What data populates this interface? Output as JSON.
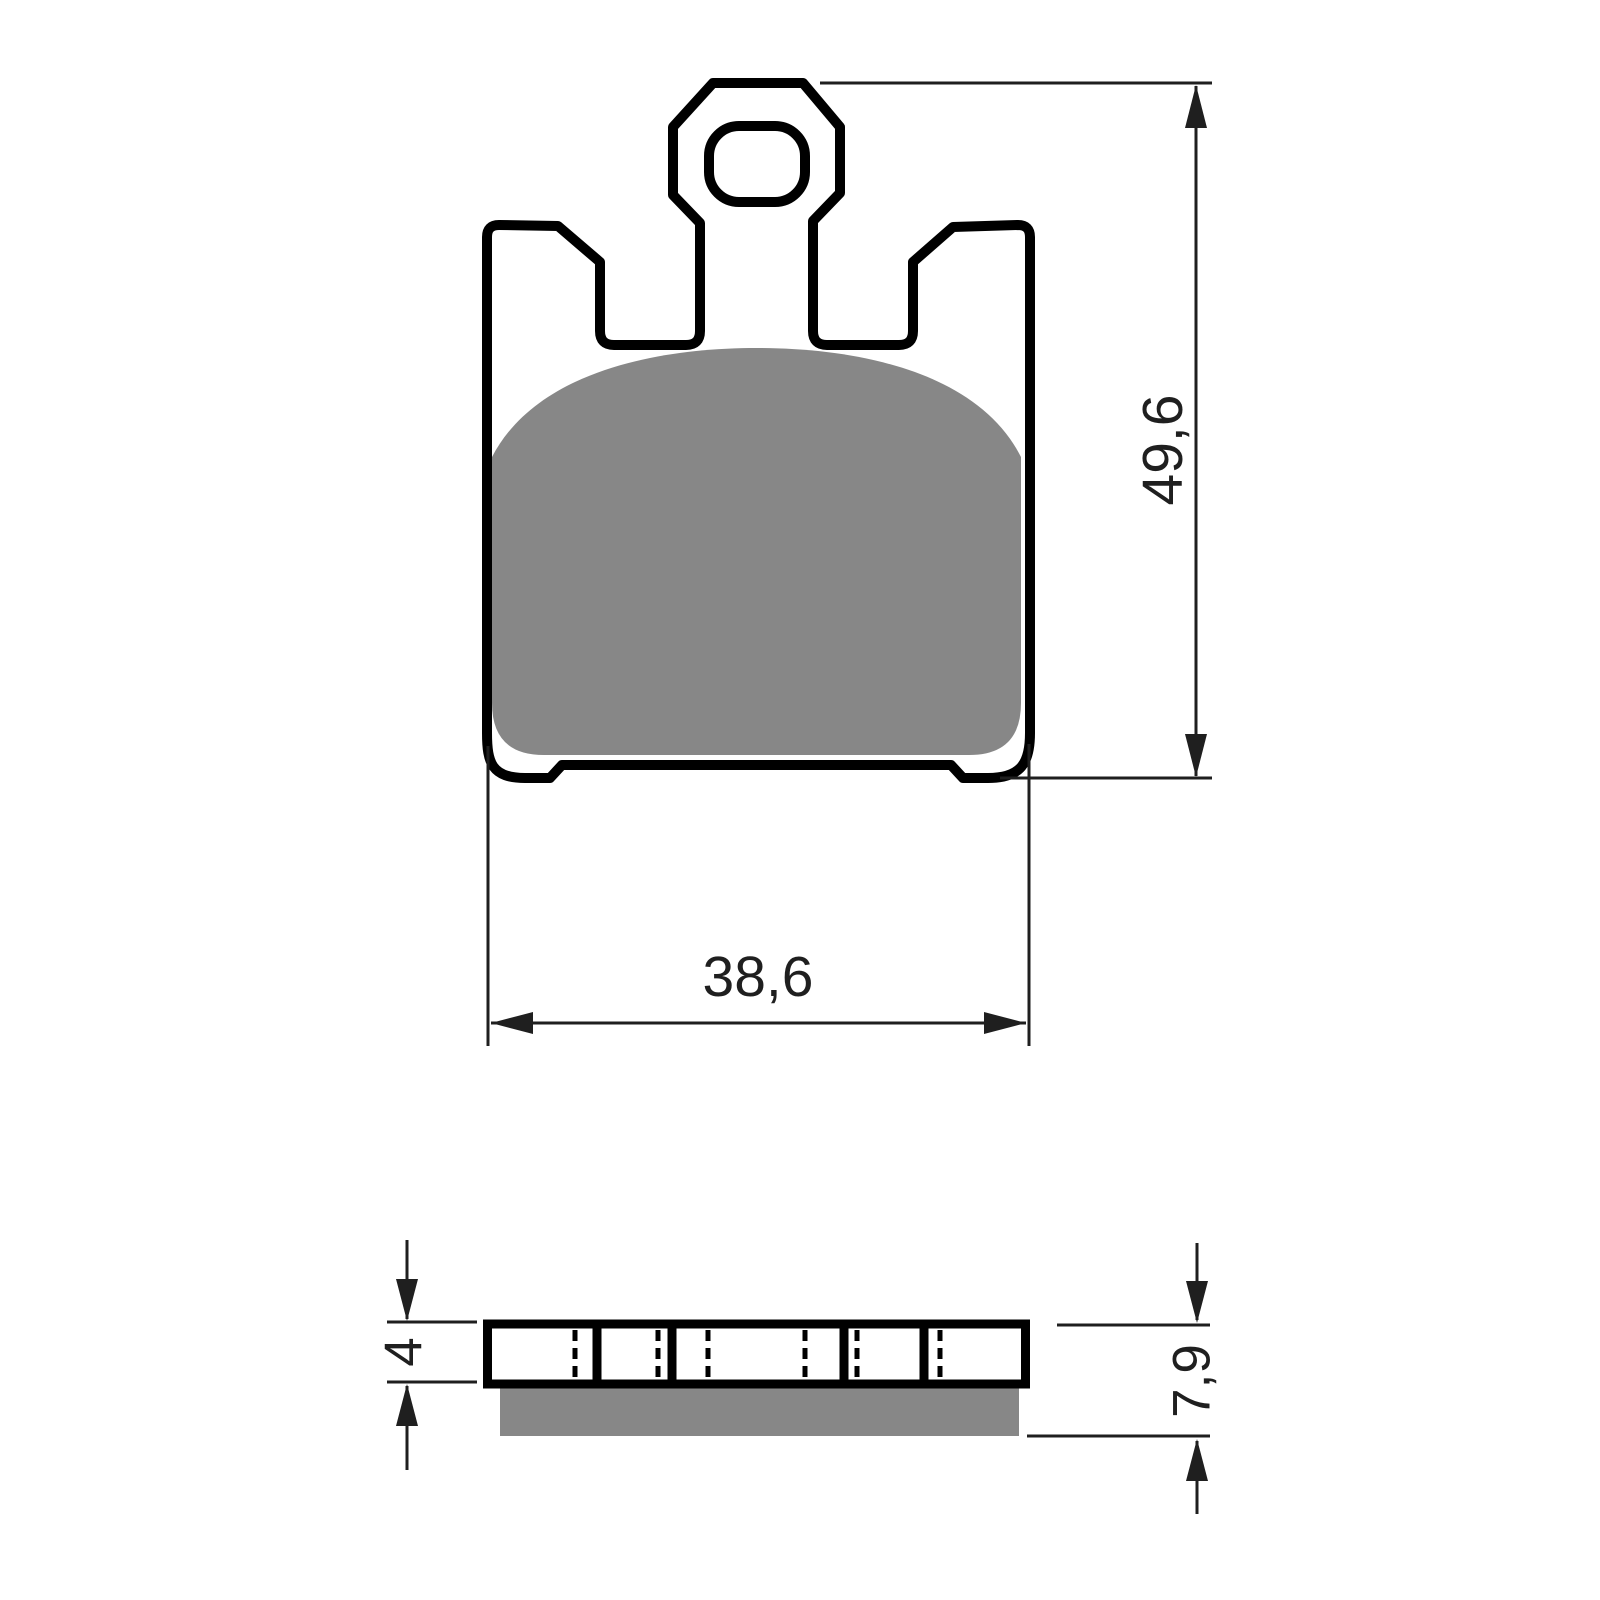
{
  "drawing": {
    "background_color": "#ffffff",
    "outline_color": "#000000",
    "dimension_color": "#1f1f1f",
    "friction_color": "#878787",
    "front_view": {
      "height_mm": "49,6",
      "width_mm": "38,6"
    },
    "side_view": {
      "plate_thickness_mm": "4",
      "total_thickness_mm": "7,9"
    }
  }
}
